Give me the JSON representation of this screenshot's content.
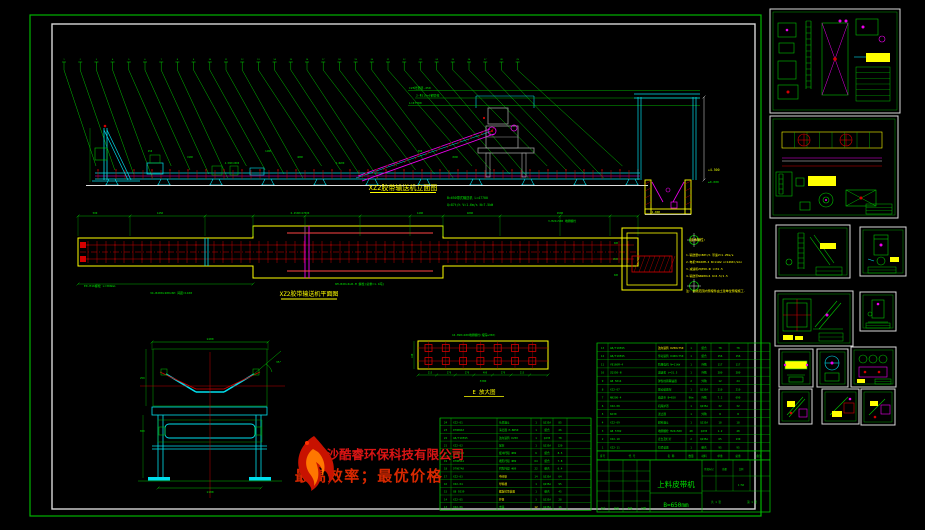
{
  "titles": {
    "elevation": "XZ2胶带输送机立面图",
    "plan": "XZ2胶带输送机平面图",
    "detail_e": "E 放大图"
  },
  "elevation": {
    "balloon_count": 29,
    "notes": [
      "B=650带式输送机 L=47700",
      "Q=87t/h V=1.6m/s N=7.5kW"
    ],
    "top_dims": [
      "C25砼垫层-250",
      "2-Φ219×6钢管柱",
      "L=47700"
    ],
    "level_marks": [
      "+4.500",
      "±0.000",
      "-1.800"
    ],
    "dim_labels": [
      "450",
      "1900",
      "4-500=2000",
      "1400",
      "4000",
      "2-Φ200",
      "500",
      "4500"
    ]
  },
  "plan": {
    "top_dims": [
      "500",
      "1450",
      "6-4500=27000",
      "1400",
      "4000",
      "4500"
    ],
    "notes": [
      "E0-M16螺栓 L=300mm",
      "34-B200×200×6H 间距≈1100",
      "6M-B20×4LB-M 螺栓(总重≈1.1吨)",
      "3-M24×500 地脚螺栓"
    ],
    "pit_dims": [
      "600",
      "1500",
      "600"
    ]
  },
  "section": {
    "dims": [
      "1400",
      "35°",
      "250",
      "650",
      "1100"
    ]
  },
  "detail_e": {
    "note": "16-M20×400地脚螺栓(埋深≥350)",
    "dims": [
      "215",
      "270",
      "270",
      "400",
      "270",
      "215"
    ],
    "overall": "3300",
    "side": "440"
  },
  "tech": {
    "heading": "技术特性:",
    "lines": [
      "1.输送量Q=80t/h 带速V=1.25m/s",
      "2.电机YB160M-4 N=11kW n=1460r/min",
      "3.减速机ZQ350-Ⅲ i=31.5",
      "4.输送带NN200×4 δ=4.5/1.5"
    ],
    "footnote": "注: 斜线范围内预埋件由土建单位预埋施工."
  },
  "watermark": {
    "company": "长沙酷睿环保科技有限公司",
    "slogan": "最高效率；最优价格"
  },
  "bom_left": {
    "rows": [
      [
        "24",
        "XZ2-01",
        "头部漏斗",
        "1",
        "Q235A",
        "85",
        ""
      ],
      [
        "23",
        "DTⅡ08A3",
        "清扫器 H-B650",
        "1",
        "组合",
        "26",
        ""
      ],
      [
        "22",
        "GB/T10595",
        "改向滚筒 D250",
        "1",
        "Q235",
        "78",
        ""
      ],
      [
        "21",
        "XZ2-02",
        "尾架",
        "1",
        "Q235A",
        "120",
        ""
      ],
      [
        "20",
        "DTⅡ06A2",
        "缓冲托辊 Φ89",
        "6",
        "组合",
        "8.5",
        ""
      ],
      [
        "19",
        "DTⅡ05A1",
        "槽形托辊 Φ89",
        "64",
        "组合",
        "7.8",
        ""
      ],
      [
        "18",
        "DTⅡ07A0",
        "回程托辊 Φ89",
        "22",
        "组合",
        "6.4",
        ""
      ],
      [
        "17",
        "XZ2-03",
        "中间架",
        "14",
        "Q235A",
        "64",
        ""
      ],
      [
        "16",
        "XZ2-04",
        "导料槽",
        "1",
        "Q235A",
        "95",
        ""
      ],
      [
        "15",
        "GB 9239",
        "螺旋拉紧装置",
        "1",
        "组合",
        "45",
        ""
      ],
      [
        "14",
        "XZ2-05",
        "护罩",
        "3",
        "Q235A",
        "28",
        ""
      ],
      [
        "13",
        "XZ2-06",
        "支腿",
        "12",
        "Q235A",
        "16",
        ""
      ]
    ]
  },
  "bom_right": {
    "header": [
      "序号",
      "代 号",
      "名 称",
      "数量",
      "材料",
      "单重",
      "总重",
      "备注"
    ],
    "rows": [
      [
        "13",
        "GB/T10595",
        "改向滚筒 D250×750",
        "1",
        "组合",
        "78",
        "78",
        ""
      ],
      [
        "12",
        "GB/T10595",
        "传动滚筒 D400×750",
        "1",
        "组合",
        "156",
        "156",
        ""
      ],
      [
        "11",
        "YB160M-4",
        "防爆电机 N=11kW",
        "1",
        "外购",
        "117",
        "117",
        ""
      ],
      [
        "10",
        "ZQ350-Ⅲ",
        "减速机 i=31.5",
        "1",
        "外购",
        "280",
        "280",
        ""
      ],
      [
        "9",
        "GB 5014",
        "弹性柱销联轴器",
        "2",
        "外购",
        "12",
        "24",
        ""
      ],
      [
        "8",
        "XZ2-07",
        "驱动装置架",
        "1",
        "Q235A",
        "210",
        "210",
        ""
      ],
      [
        "7",
        "NN200-4",
        "输送带 B=650",
        "96m",
        "外购",
        "7.2",
        "690",
        ""
      ],
      [
        "6",
        "XZ2-08",
        "机尾护罩",
        "1",
        "Q235A",
        "32",
        "32",
        ""
      ],
      [
        "5",
        "NJ30",
        "逆止器",
        "1",
        "外购",
        "8",
        "8",
        ""
      ],
      [
        "4",
        "XZ2-09",
        "卸料漏斗",
        "1",
        "Q235A",
        "18",
        "18",
        ""
      ],
      [
        "3",
        "GB 5782",
        "地脚螺栓 M24×500",
        "40",
        "Q235",
        "1.2",
        "48",
        ""
      ],
      [
        "2",
        "XZ2-10",
        "走台及栏杆",
        "2",
        "Q235A",
        "65",
        "130",
        ""
      ],
      [
        "1",
        "XZ2-11",
        "拉紧装置",
        "1",
        "组合",
        "95",
        "95",
        ""
      ]
    ]
  },
  "title_block": {
    "product": "上料皮带机",
    "spec": "B=650mm",
    "left_labels": [
      "设计",
      "校核",
      "审核",
      "日期"
    ],
    "right_labels": [
      "阶段标记",
      "质量",
      "比例",
      "1:50",
      "共 1 张",
      "第 1 张"
    ]
  }
}
